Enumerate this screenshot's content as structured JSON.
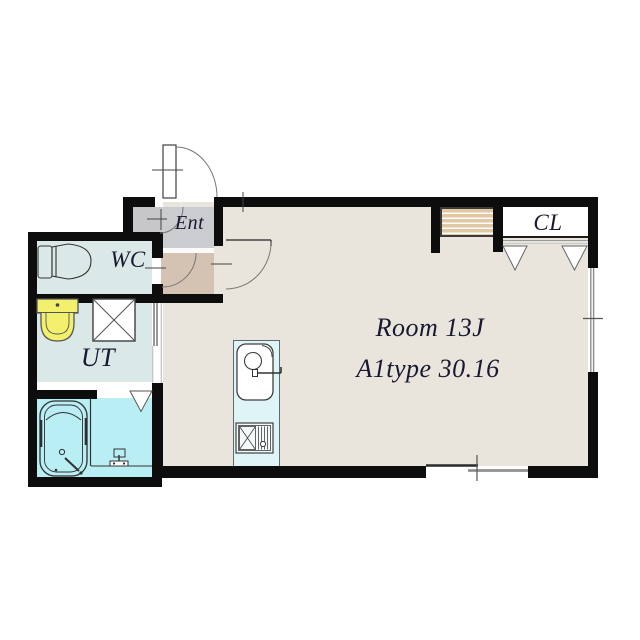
{
  "plan": {
    "type": "apartment-floorplan",
    "labels": {
      "entrance": "Ent",
      "toilet": "WC",
      "utility": "UT",
      "closet": "CL",
      "main_room_line1": "Room 13J",
      "main_room_line2": "A1type 30.16"
    },
    "colors": {
      "wall": "#0d0d0d",
      "main_floor": "#e9e5dd",
      "wet_room_floor": "#dbe8e8",
      "bathroom_floor": "#b9eef4",
      "kitchen_unit": "#def4f6",
      "entrance_hall": "#cbccd0",
      "entrance_step": "#d4c3b2",
      "porch": "#c7c7c9",
      "washbasin": "#f3f06e",
      "shoe_shelf": "#e2c8a2",
      "window_line": "#8c8c8c",
      "label_text": "#181830"
    },
    "fixtures": [
      "entry-door",
      "entrance-inner-door-swing",
      "room-door",
      "wc-door-opening",
      "sliding-door-utility",
      "bath-folding-door-mark",
      "toilet",
      "washbasin",
      "washing-machine-pan",
      "bathtub",
      "shower-faucet",
      "kitchen-sink",
      "gas-stove",
      "shoe-shelf",
      "closet-rail",
      "closet-door-marks",
      "window-east",
      "window-south"
    ]
  }
}
